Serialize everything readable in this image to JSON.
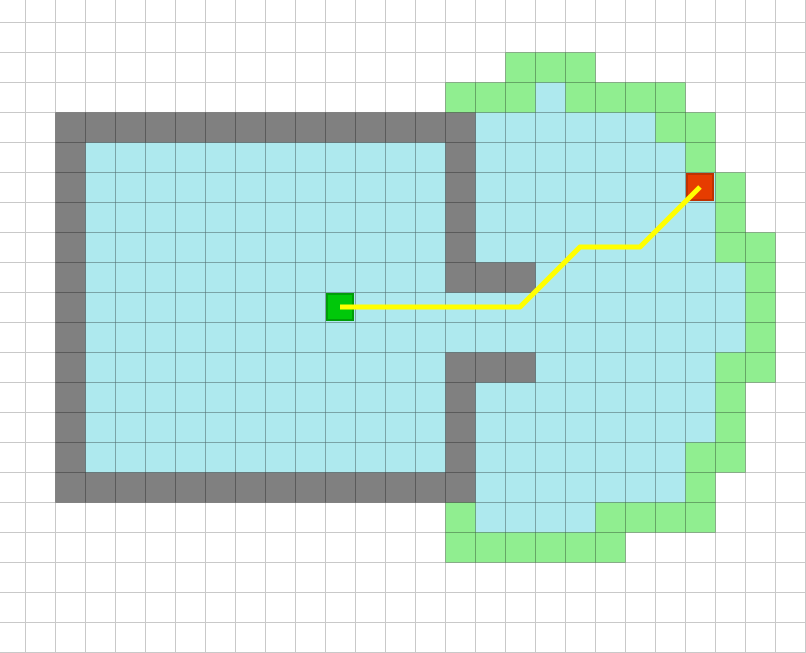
{
  "map": {
    "description": "occupancy-grid exploration map with frontier cells, start marker, goal marker and planned path",
    "canvas": {
      "width": 806,
      "height": 653
    },
    "grid": {
      "cols": 27,
      "rows": 22,
      "cell_size": 30,
      "offset_x": -5,
      "offset_y": -8
    },
    "colors": {
      "background": "#ffffff",
      "grid_line": "#c9c9c9",
      "cell_stroke": "rgba(0,0,0,0.21)",
      "wall": "#808080",
      "free": "#aee9ee",
      "frontier": "#90ee90",
      "start_fill": "#00c80a",
      "start_stroke": "#009e08",
      "goal_fill": "#e63c00",
      "goal_stroke": "#bf3200",
      "path": "#ffff00"
    },
    "legend": {
      "wall": "obstacle cell",
      "free": "known free cell",
      "frontier": "frontier cell",
      "start": "start position",
      "goal": "goal position",
      "path": "planned path"
    },
    "wall_ranges": [
      [
        4,
        2,
        15
      ],
      [
        5,
        2,
        2
      ],
      [
        5,
        15,
        15
      ],
      [
        6,
        2,
        2
      ],
      [
        6,
        15,
        15
      ],
      [
        7,
        2,
        2
      ],
      [
        7,
        15,
        15
      ],
      [
        8,
        2,
        2
      ],
      [
        8,
        15,
        15
      ],
      [
        9,
        2,
        2
      ],
      [
        9,
        15,
        17
      ],
      [
        10,
        2,
        2
      ],
      [
        11,
        2,
        2
      ],
      [
        12,
        2,
        2
      ],
      [
        12,
        15,
        17
      ],
      [
        13,
        2,
        2
      ],
      [
        13,
        15,
        15
      ],
      [
        14,
        2,
        2
      ],
      [
        14,
        15,
        15
      ],
      [
        15,
        2,
        2
      ],
      [
        15,
        15,
        15
      ],
      [
        16,
        2,
        15
      ]
    ],
    "free_ranges": [
      [
        3,
        18,
        18
      ],
      [
        4,
        16,
        21
      ],
      [
        5,
        3,
        14
      ],
      [
        5,
        16,
        22
      ],
      [
        6,
        3,
        14
      ],
      [
        6,
        16,
        23
      ],
      [
        7,
        3,
        14
      ],
      [
        7,
        16,
        23
      ],
      [
        8,
        3,
        14
      ],
      [
        8,
        16,
        23
      ],
      [
        9,
        3,
        14
      ],
      [
        9,
        18,
        24
      ],
      [
        10,
        3,
        24
      ],
      [
        11,
        3,
        24
      ],
      [
        12,
        3,
        14
      ],
      [
        12,
        18,
        23
      ],
      [
        13,
        3,
        14
      ],
      [
        13,
        16,
        23
      ],
      [
        14,
        3,
        14
      ],
      [
        14,
        16,
        23
      ],
      [
        15,
        3,
        14
      ],
      [
        15,
        16,
        22
      ],
      [
        16,
        16,
        22
      ],
      [
        17,
        16,
        19
      ]
    ],
    "frontier_ranges": [
      [
        2,
        17,
        19
      ],
      [
        3,
        15,
        17
      ],
      [
        3,
        19,
        22
      ],
      [
        4,
        22,
        23
      ],
      [
        5,
        23,
        23
      ],
      [
        6,
        24,
        24
      ],
      [
        7,
        24,
        24
      ],
      [
        8,
        24,
        25
      ],
      [
        9,
        25,
        25
      ],
      [
        10,
        25,
        25
      ],
      [
        11,
        25,
        25
      ],
      [
        12,
        24,
        25
      ],
      [
        13,
        24,
        24
      ],
      [
        14,
        24,
        24
      ],
      [
        15,
        23,
        24
      ],
      [
        16,
        23,
        23
      ],
      [
        17,
        15,
        15
      ],
      [
        17,
        20,
        23
      ],
      [
        18,
        15,
        20
      ]
    ],
    "start_cell": [
      11,
      10
    ],
    "goal_cell": [
      23,
      6
    ],
    "marker_inset": 2,
    "path_cells": [
      [
        11,
        10
      ],
      [
        17,
        10
      ],
      [
        19,
        8
      ],
      [
        21,
        8
      ],
      [
        23,
        6
      ]
    ],
    "path_width": 5
  }
}
